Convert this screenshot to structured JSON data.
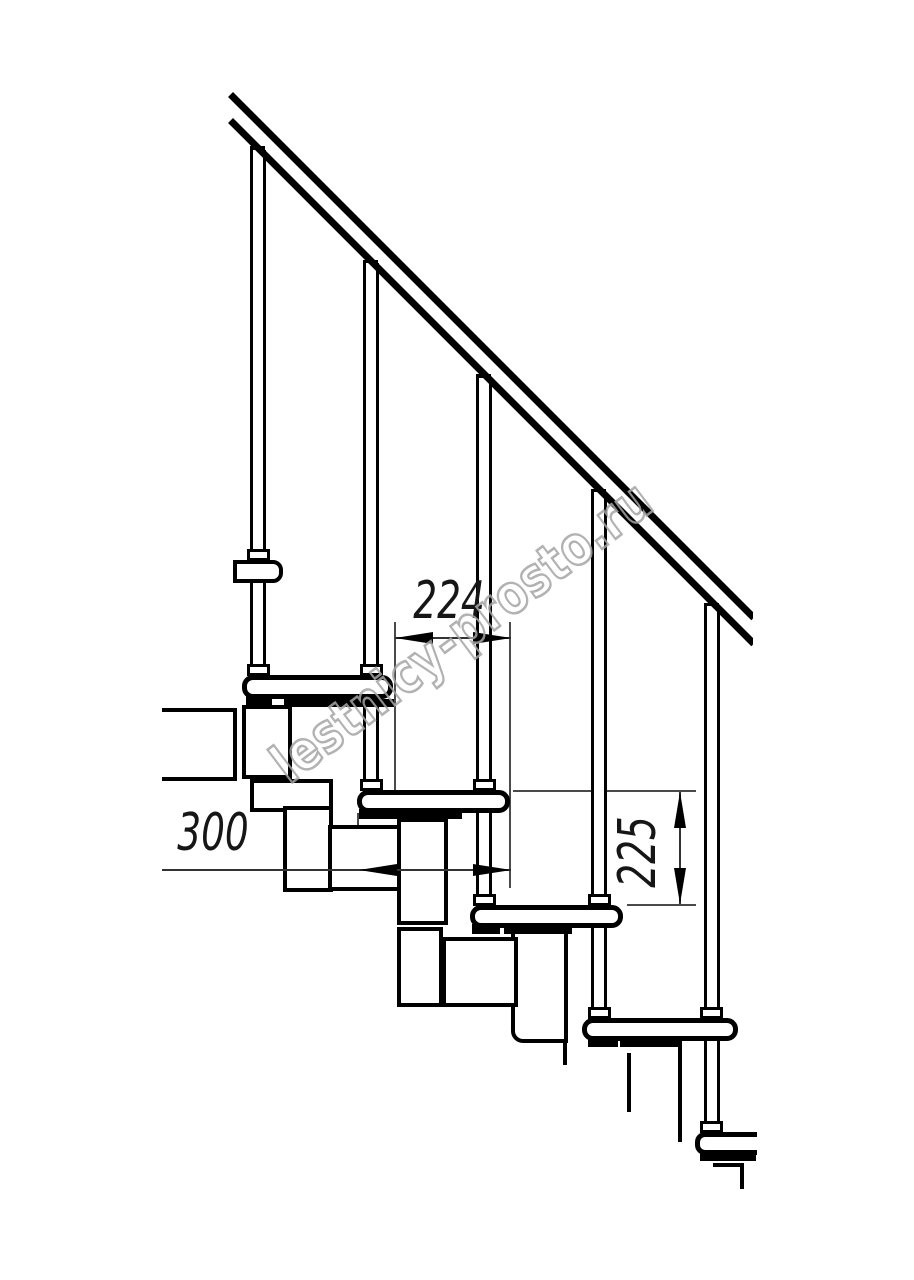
{
  "watermark": {
    "text": "lestnicy-prosto.ru",
    "color": "#a5a5a5",
    "angle_deg": -37
  },
  "colors": {
    "background": "#ffffff",
    "line": "#000000",
    "dim_line": "#3c3c3c",
    "text": "#161616"
  },
  "dimensions": {
    "going": {
      "label": "224",
      "value": 224,
      "orientation": "horizontal"
    },
    "tread_depth": {
      "label": "300",
      "value": 300,
      "orientation": "horizontal"
    },
    "rise": {
      "label": "225",
      "value": 225,
      "orientation": "vertical"
    }
  },
  "shapes": [
    {
      "n": "ext-line-224-left",
      "t": "v",
      "x": 394,
      "y": 622,
      "l": 168
    },
    {
      "n": "ext-line-right-shared",
      "t": "v",
      "x": 509,
      "y": 622,
      "l": 266
    },
    {
      "n": "ext-line-300-left",
      "t": "v",
      "x": 357,
      "y": 813,
      "l": 75
    },
    {
      "n": "ext-line-225-top",
      "t": "h",
      "x": 513,
      "y": 790,
      "l": 183
    },
    {
      "n": "ext-line-225-bottom",
      "t": "h",
      "x": 627,
      "y": 904,
      "l": 69
    },
    {
      "n": "rail-joint-1",
      "t": "b",
      "x": 250,
      "y": 146,
      "w": 15,
      "h": 11
    },
    {
      "n": "rail-joint-2",
      "t": "b",
      "x": 363,
      "y": 260,
      "w": 15,
      "h": 11
    },
    {
      "n": "rail-joint-3",
      "t": "b",
      "x": 476,
      "y": 374,
      "w": 15,
      "h": 11
    },
    {
      "n": "rail-joint-4",
      "t": "b",
      "x": 591,
      "y": 489,
      "w": 15,
      "h": 11
    },
    {
      "n": "rail-joint-5",
      "t": "b",
      "x": 704,
      "y": 603,
      "w": 15,
      "h": 11
    },
    {
      "n": "baluster-1",
      "t": "bal",
      "x": 250,
      "y": 150,
      "l": 527
    },
    {
      "n": "baluster-2",
      "t": "bal",
      "x": 363,
      "y": 263,
      "l": 529
    },
    {
      "n": "baluster-3",
      "t": "bal",
      "x": 476,
      "y": 378,
      "l": 529
    },
    {
      "n": "baluster-4",
      "t": "bal",
      "x": 591,
      "y": 492,
      "l": 528
    },
    {
      "n": "baluster-5",
      "t": "bal",
      "x": 704,
      "y": 606,
      "l": 528
    },
    {
      "n": "handrail-top-bar",
      "t": "bar",
      "x": 233,
      "y": 92,
      "l": 740,
      "th": 7
    },
    {
      "n": "handrail-bottom-bar",
      "t": "bar",
      "x": 233,
      "y": 118,
      "l": 740,
      "th": 7
    },
    {
      "n": "handrail-end-cut",
      "t": "cover",
      "x": 753,
      "y": 590,
      "w": 45,
      "h": 85
    },
    {
      "n": "floor-slab",
      "t": "box",
      "x": 162,
      "y": 708,
      "w": 75,
      "h": 73,
      "noleft": 1
    },
    {
      "n": "module-1a",
      "t": "box",
      "x": 242,
      "y": 705,
      "w": 50,
      "h": 74
    },
    {
      "n": "module-1b",
      "t": "box",
      "x": 250,
      "y": 779,
      "w": 83,
      "h": 33
    },
    {
      "n": "module-1c",
      "t": "box",
      "x": 283,
      "y": 806,
      "w": 50,
      "h": 86
    },
    {
      "n": "module-2b",
      "t": "box",
      "x": 397,
      "y": 818,
      "w": 51,
      "h": 107
    },
    {
      "n": "module-2c",
      "t": "box",
      "x": 397,
      "y": 927,
      "w": 46,
      "h": 80
    },
    {
      "n": "module-3c",
      "t": "box",
      "x": 511,
      "y": 930,
      "w": 57,
      "h": 113,
      "rbl": 12
    },
    {
      "n": "module-2a",
      "t": "box",
      "x": 328,
      "y": 825,
      "w": 73,
      "h": 66
    },
    {
      "n": "module-3a",
      "t": "box",
      "x": 442,
      "y": 937,
      "w": 76,
      "h": 70
    },
    {
      "n": "module-3-stub",
      "t": "vb",
      "x": 563,
      "y": 1043,
      "l": 22
    },
    {
      "n": "module-4-edge-left",
      "t": "vb",
      "x": 627,
      "y": 1053,
      "l": 59
    },
    {
      "n": "module-4-edge-right",
      "t": "vb",
      "x": 678,
      "y": 1043,
      "l": 99
    },
    {
      "n": "cut-under-tread5-h",
      "t": "hb",
      "x": 713,
      "y": 1163,
      "l": 30
    },
    {
      "n": "cut-under-tread5-v",
      "t": "vb",
      "x": 740,
      "y": 1163,
      "l": 26
    },
    {
      "n": "mount-tab-1",
      "t": "b",
      "x": 246,
      "y": 696,
      "w": 26,
      "h": 10
    },
    {
      "n": "mount-plate-1",
      "t": "b",
      "x": 284,
      "y": 699,
      "w": 110,
      "h": 8
    },
    {
      "n": "mount-tab-2",
      "t": "b",
      "x": 359,
      "y": 809,
      "w": 30,
      "h": 10
    },
    {
      "n": "mount-plate-2",
      "t": "b",
      "x": 389,
      "y": 811,
      "w": 73,
      "h": 8
    },
    {
      "n": "mount-tab-3",
      "t": "b",
      "x": 472,
      "y": 924,
      "w": 28,
      "h": 10
    },
    {
      "n": "mount-plate-3",
      "t": "b",
      "x": 504,
      "y": 926,
      "w": 68,
      "h": 8
    },
    {
      "n": "mount-tab-4",
      "t": "b",
      "x": 588,
      "y": 1037,
      "w": 30,
      "h": 10
    },
    {
      "n": "mount-plate-4",
      "t": "b",
      "x": 620,
      "y": 1039,
      "w": 62,
      "h": 8
    },
    {
      "n": "mount-tab-5",
      "t": "b",
      "x": 700,
      "y": 1151,
      "w": 32,
      "h": 10
    },
    {
      "n": "mount-plate-5",
      "t": "b",
      "x": 729,
      "y": 1150,
      "w": 27,
      "h": 11
    },
    {
      "n": "tread-0-fragment",
      "t": "tread",
      "x": 233,
      "y": 560,
      "w": 50,
      "h": 23,
      "bw": 4,
      "r": "0 10px 10px 0"
    },
    {
      "n": "tread-1",
      "t": "tread",
      "x": 242,
      "y": 675,
      "w": 151,
      "h": 24
    },
    {
      "n": "tread-2",
      "t": "tread",
      "x": 357,
      "y": 790,
      "w": 153,
      "h": 23
    },
    {
      "n": "tread-3",
      "t": "tread",
      "x": 470,
      "y": 905,
      "w": 153,
      "h": 23
    },
    {
      "n": "tread-4",
      "t": "tread",
      "x": 582,
      "y": 1018,
      "w": 156,
      "h": 23
    },
    {
      "n": "tread-5-cut",
      "t": "tread",
      "x": 695,
      "y": 1132,
      "w": 62,
      "h": 23,
      "r": "10px 0 0 10px",
      "noright": 1
    },
    {
      "n": "baluster-1-collar-mid",
      "t": "col",
      "x": 247,
      "y": 549
    },
    {
      "n": "baluster-1-collar-bottom",
      "t": "col",
      "x": 247,
      "y": 664
    },
    {
      "n": "baluster-2-collar-mid",
      "t": "col",
      "x": 360,
      "y": 664
    },
    {
      "n": "baluster-2-collar-bottom",
      "t": "col",
      "x": 360,
      "y": 779
    },
    {
      "n": "baluster-3-collar-mid",
      "t": "col",
      "x": 473,
      "y": 779
    },
    {
      "n": "baluster-3-collar-bottom",
      "t": "col",
      "x": 473,
      "y": 894
    },
    {
      "n": "baluster-4-collar-mid",
      "t": "col",
      "x": 588,
      "y": 894
    },
    {
      "n": "baluster-4-collar-bottom",
      "t": "col",
      "x": 588,
      "y": 1007
    },
    {
      "n": "baluster-5-collar-mid",
      "t": "col",
      "x": 700,
      "y": 1007
    },
    {
      "n": "baluster-5-collar-bottom",
      "t": "col",
      "x": 700,
      "y": 1121
    },
    {
      "n": "dim-224-line",
      "t": "h",
      "x": 395,
      "y": 637,
      "l": 116,
      "th": 2,
      "c": "#333333"
    },
    {
      "n": "dim-300-line",
      "t": "h",
      "x": 162,
      "y": 869,
      "l": 349,
      "th": 2,
      "c": "#333333"
    },
    {
      "n": "dim-225-line",
      "t": "v",
      "x": 679,
      "y": 792,
      "l": 112,
      "th": 2,
      "c": "#333333"
    },
    {
      "n": "dim-224-arrow-left",
      "t": "al",
      "x": 395,
      "y": 638
    },
    {
      "n": "dim-224-arrow-right",
      "t": "ar",
      "x": 511,
      "y": 638
    },
    {
      "n": "dim-300-arrow-left",
      "t": "al",
      "x": 359,
      "y": 870
    },
    {
      "n": "dim-300-arrow-right",
      "t": "ar",
      "x": 511,
      "y": 870
    },
    {
      "n": "dim-225-arrow-up",
      "t": "au",
      "x": 680,
      "y": 792
    },
    {
      "n": "dim-225-arrow-down",
      "t": "ad",
      "x": 680,
      "y": 904
    }
  ]
}
